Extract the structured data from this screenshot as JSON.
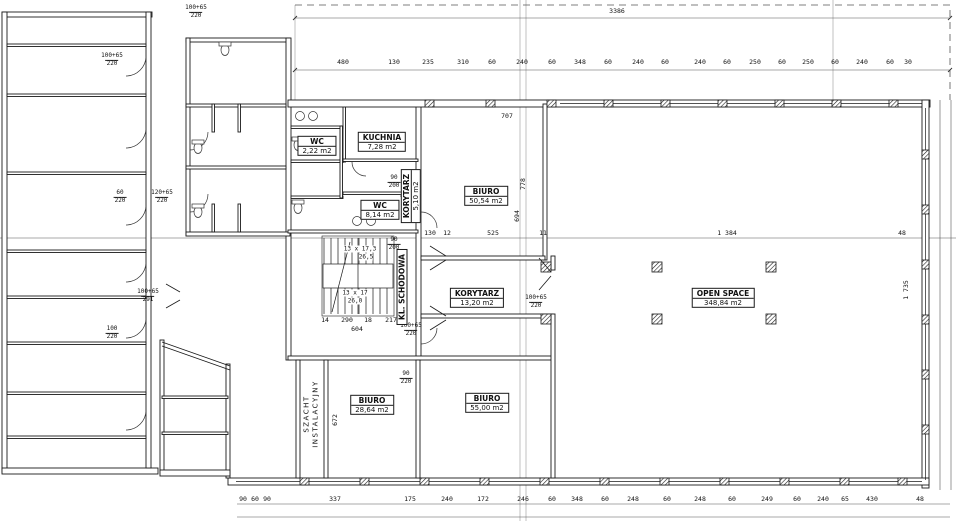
{
  "rooms": {
    "biuro_top": {
      "name": "BIURO",
      "area": "50,54 m2"
    },
    "open_space": {
      "name": "OPEN SPACE",
      "area": "348,84 m2"
    },
    "biuro_sw": {
      "name": "BIURO",
      "area": "28,64 m2"
    },
    "biuro_s": {
      "name": "BIURO",
      "area": "55,00 m2"
    },
    "korytarz_main": {
      "name": "KORYTARZ",
      "area": "13,20 m2"
    },
    "korytarz_small": {
      "name": "KORYTARZ",
      "area": "5,10 m2"
    },
    "kuchnia": {
      "name": "KUCHNIA",
      "area": "7,28 m2"
    },
    "wc_small": {
      "name": "WC",
      "area": "2,22 m2"
    },
    "wc_big": {
      "name": "WC",
      "area": "8,14 m2"
    },
    "klatka": {
      "name": "KL. SCHODOWA"
    },
    "szacht": {
      "line1": "SZACHT",
      "line2": "INSTALACYJNY"
    }
  },
  "stairs": {
    "flight_top": "13 x 17,3",
    "flight_top_tread": "26,5",
    "flight_bottom": "13 x 17",
    "flight_bottom_tread": "26,0"
  },
  "dimensions": {
    "top_total": "3386",
    "top_chain": [
      "480",
      "130",
      "235",
      "310",
      "60",
      "240",
      "60",
      "348",
      "60",
      "240",
      "60",
      "240",
      "60",
      "250",
      "60",
      "250",
      "60",
      "240",
      "60",
      "30"
    ],
    "mid_chain": [
      "130",
      "12",
      "525",
      "11",
      "1 384",
      "48"
    ],
    "bottom_chain": [
      "90",
      "60",
      "90",
      "337",
      "175",
      "240",
      "172",
      "246",
      "60",
      "348",
      "60",
      "248",
      "60",
      "248",
      "60",
      "249",
      "60",
      "240",
      "65",
      "430",
      "48"
    ],
    "stair_row": [
      "14",
      "290",
      "18",
      "217"
    ],
    "stair_total": "604",
    "misc": {
      "w707": "707",
      "v778": "778",
      "v694": "694",
      "v672": "672",
      "v1735": "1 735"
    }
  },
  "door_marks": [
    {
      "w": "100+65",
      "h": "220"
    },
    {
      "w": "100+65",
      "h": "220"
    },
    {
      "w": "60",
      "h": "220"
    },
    {
      "w": "120+65",
      "h": "220"
    },
    {
      "w": "100+65",
      "h": "291"
    },
    {
      "w": "90",
      "h": "200"
    },
    {
      "w": "90",
      "h": "200"
    },
    {
      "w": "100+65",
      "h": "220"
    },
    {
      "w": "100+65",
      "h": "220"
    },
    {
      "w": "90",
      "h": "220"
    },
    {
      "w": "100",
      "h": "220"
    }
  ],
  "colors": {
    "line": "#1a1a1a",
    "grid": "#999",
    "dim_line": "#555"
  }
}
